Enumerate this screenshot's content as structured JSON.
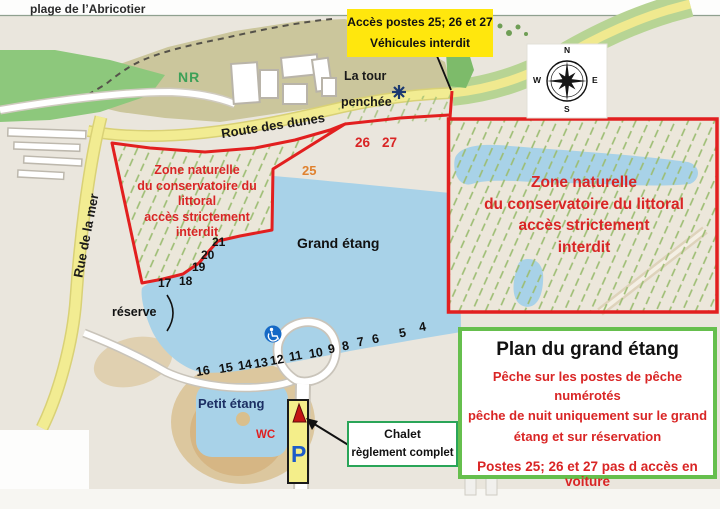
{
  "labels": {
    "beach": "plage de l’Abricotier",
    "nr": "NR",
    "route_dunes": "Route des dunes",
    "rue_mer": "Rue de la mer",
    "tour_1": "La  tour",
    "tour_2": "penchée",
    "grand_etang": "Grand étang",
    "petit_etang": "Petit étang",
    "reserve": "réserve",
    "wc": "WC",
    "parking": "P"
  },
  "access_box": {
    "line1": "Accès postes 25; 26 et 27",
    "line2": "Véhicules interdit"
  },
  "zone_left": {
    "l1": "Zone naturelle",
    "l2": "du conservatoire du littoral",
    "l3": "accès strictement",
    "l4": "interdit"
  },
  "zone_right": {
    "l1": "Zone naturelle",
    "l2": "du conservatoire du littoral",
    "l3": "accès strictement",
    "l4": "interdit"
  },
  "chalet_box": {
    "line1": "Chalet",
    "line2": "règlement complet"
  },
  "info_box": {
    "title": "Plan du grand étang",
    "rule1": "Pêche sur les postes de pêche numérotés",
    "rule2": "pêche de nuit uniquement sur le grand",
    "rule3": "étang  et sur réservation",
    "rule4": "Postes 25; 26 et 27 pas d accès en voiture"
  },
  "posts": {
    "nw": [
      "21",
      "20",
      "19",
      "18",
      "17"
    ],
    "south": [
      "16",
      "15",
      "14",
      "13",
      "12",
      "11",
      "10",
      "9",
      "8",
      "7",
      "6",
      "5",
      "4"
    ],
    "p25": "25",
    "p26": "26",
    "p27": "27"
  },
  "compass": {
    "n": "N",
    "e": "E",
    "s": "S",
    "w": "W"
  },
  "colors": {
    "red_zone": "#e21f1f",
    "zone_text_red": "#d92525",
    "water": "#a8d2e8",
    "road_yellow": "#f2ec92",
    "hatch_green": "#9cbd72",
    "warning_yellow": "#ffe70d",
    "info_border": "#66bf4d",
    "chalet_border": "#2aa558",
    "parking_blue": "#1d5cc8",
    "orange_25": "#e0812e"
  }
}
